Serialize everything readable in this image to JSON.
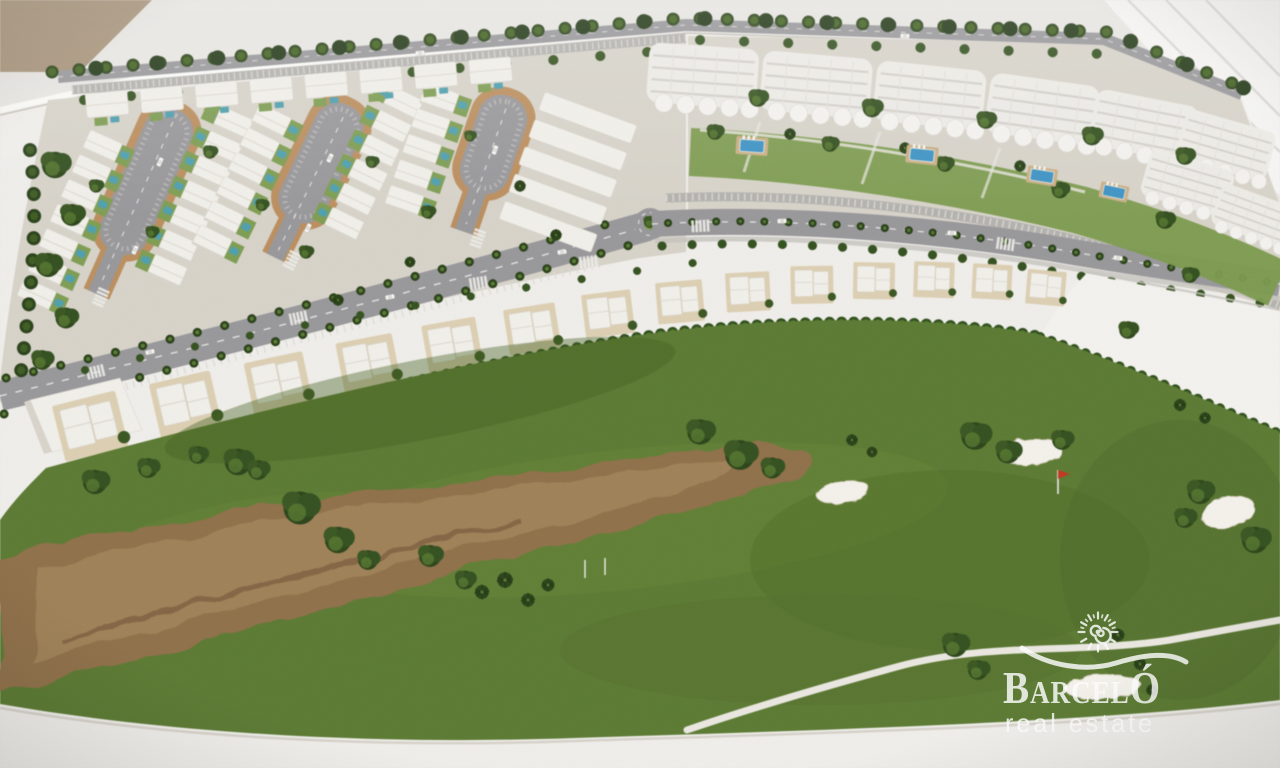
{
  "meta": {
    "domain": "Natural-Image",
    "description": "Aerial photograph of an architectural scale model (maquette) of a coastal golf resort development: a villa district with cul-de-sac streets, an apartment district with garden pools and a palm-lined avenue, a row of townhouses, and a golf course with a sandy waste area, bunkers and a red pin flag. Watermarked with the Barceló real estate logo.",
    "image_width": 1280,
    "image_height": 768
  },
  "watermark": {
    "brand": "BARCELÓ",
    "brand_display": "BarcelÓ",
    "tagline": "real estate",
    "icon": "sun-spiral-over-wave-logo",
    "color": "#ffffff"
  },
  "model": {
    "subject": "masterplan maquette of a golf resort residential development on a white display table",
    "districts": [
      {
        "name": "villa district",
        "detail": "rows of white detached villas with private teal pools around three tan-ringed cul-de-sac streets, tree-lined boulevard with parking along the top"
      },
      {
        "name": "apartment district",
        "detail": "white apartment blocks with curved balconies, communal gardens with blue pools and sun loungers, palm-lined avenue with parking and a roundabout"
      },
      {
        "name": "townhouse row",
        "detail": "white two-storey townhouses facing the golf course behind a bright boundary hedge"
      },
      {
        "name": "golf course",
        "detail": "mottled green fairway with a large sandy waste area, white sand bunkers, one red pin flag and a winding white cart path"
      }
    ],
    "counts": {
      "cul_de_sac_streets": 3,
      "communal_pools": 4,
      "sand_bunkers": 4,
      "pin_flags": 1,
      "roundabouts": 1
    },
    "palette": {
      "background": "#e8e6e2",
      "wall_tan": "#a79379",
      "base_white": "#f0eeea",
      "ground": "#d7d3c9",
      "asphalt": "#98979a",
      "sidewalk_tan": "#bb8e5e",
      "grass_green": "#5b7a32",
      "waste_brown": "#8f7049",
      "tree_green": "#2c4419",
      "hedge_green": "#3f6a1f",
      "pool_teal": "#4f9fae",
      "pool_blue": "#3e93c4",
      "deck_tan": "#c9b088",
      "house_white": "#f1efe9",
      "bunker_sand": "#f3f1ea",
      "flag_red": "#c2371f"
    }
  }
}
